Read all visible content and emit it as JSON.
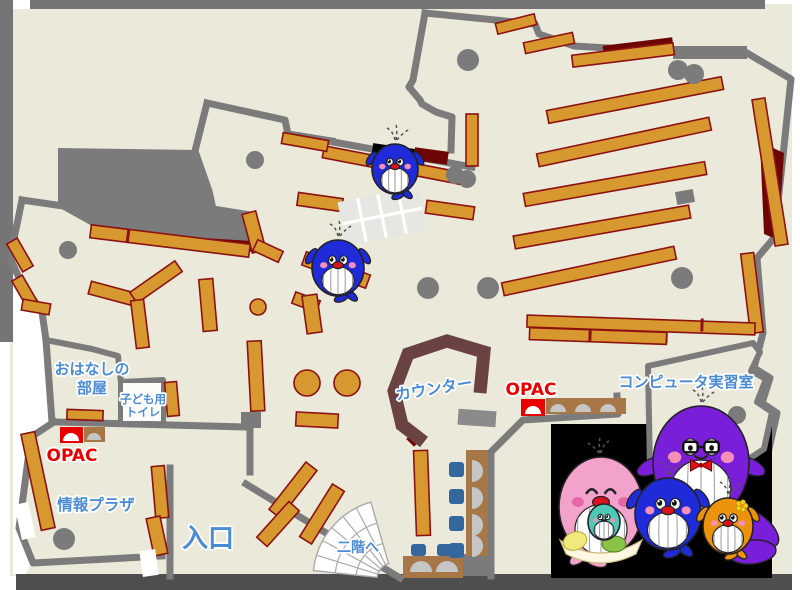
{
  "title": "library-first-floor-map",
  "labels": {
    "storytime_room_line1": "おはなしの",
    "storytime_room_line2": "部屋",
    "kids_toilet_line1": "子ども用",
    "kids_toilet_line2": "トイレ",
    "opac_left": "OPAC",
    "opac_center": "OPAC",
    "info_plaza": "情報プラザ",
    "entrance": "入口",
    "to_second_floor": "二階へ",
    "counter": "カウンター",
    "computer_room": "コンピュータ実習室"
  },
  "colors": {
    "floor": "#EBE9DA",
    "wall_gray": "#7B7B7B",
    "frame_gray": "#757575",
    "bottom_bar": "#4E4E4E",
    "shelf_tan": "#D7992F",
    "shelf_border": "#8C1111",
    "dark_red": "#6E0505",
    "counter_brown": "#6B4242",
    "desk_brown": "#A87747",
    "chair_blue": "#33679E",
    "monitor_gray": "#C6C6C6",
    "panel_black": "#000000",
    "label_blue": "#4B8BD5",
    "opac_red": "#E80000",
    "table_gray": "#E6E6E3",
    "stairs_line": "#A9A9B0"
  },
  "mascots": {
    "father_whale": {
      "body": "#7A1FD9",
      "accessories": "glasses, red bow tie"
    },
    "mother_whale": {
      "body": "#F2A2CB",
      "accessories": "white frill apron, holds baby"
    },
    "child_whale_blue": {
      "body": "#1F2BD8"
    },
    "child_whale_orange": {
      "body": "#EC930B",
      "accessories": "yellow flower"
    },
    "baby_whale": {
      "body": "#4FC8B8"
    },
    "map_whale": {
      "body": "#1F2BD8"
    },
    "cheek_pink": "#F48FB8"
  }
}
